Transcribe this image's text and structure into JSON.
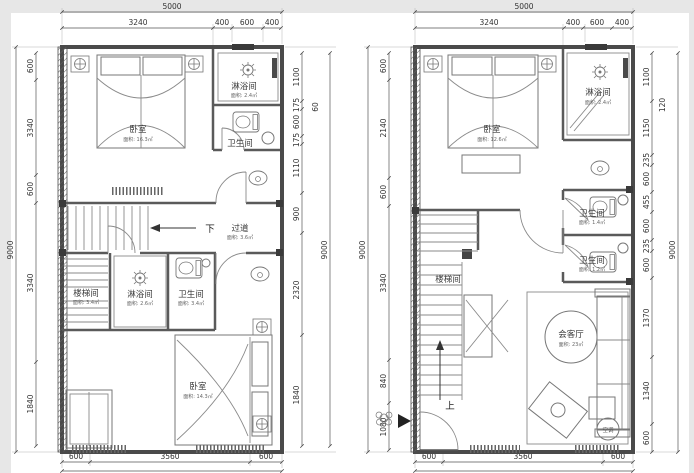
{
  "d": {
    "title": "duplex-floor-plans",
    "colors": {
      "wall": "#4a4a4a",
      "line": "#8a8a8a",
      "dim": "#555555",
      "text": "#333333",
      "paper": "#ffffff",
      "margin": "#e7e7e7"
    },
    "lp": {
      "overall_w": "5000",
      "top": [
        "3240",
        "400",
        "600",
        "400"
      ],
      "overall_h_l": "9000",
      "left": [
        "600",
        "3340",
        "600",
        "3340",
        "1840"
      ],
      "overall_h_r": "9000",
      "right": [
        "1100",
        "175",
        "600",
        "175",
        "1110",
        "900",
        "2320",
        "1840"
      ],
      "right_sec": "60",
      "bottom": [
        "600",
        "3560",
        "600"
      ],
      "rooms": {
        "bedroom_top": {
          "label": "卧室",
          "area": "面积: 16.3㎡"
        },
        "shower_top": {
          "label": "淋浴间",
          "area": "面积: 2.4㎡"
        },
        "wc_top": {
          "label": "卫生间",
          "area": "面积: 2.1㎡"
        },
        "corridor": {
          "label": "过道",
          "area": "面积: 3.6㎡",
          "dir": "下"
        },
        "stair": {
          "label": "楼梯间",
          "area": "面积: 3.4㎡"
        },
        "shower_mid": {
          "label": "淋浴间",
          "area": "面积: 2.6㎡"
        },
        "wc_mid": {
          "label": "卫生间",
          "area": "面积: 3.4㎡"
        },
        "bedroom_bottom": {
          "label": "卧室",
          "area": "面积: 14.3㎡"
        }
      }
    },
    "rp": {
      "overall_w": "5000",
      "top": [
        "3240",
        "400",
        "600",
        "400"
      ],
      "overall_h_l": "9000",
      "left": [
        "600",
        "2140",
        "600",
        "3340",
        "840",
        "1080"
      ],
      "overall_h_r": "9000",
      "right": [
        "1100",
        "1150",
        "235",
        "600",
        "455",
        "600",
        "235",
        "600",
        "1370",
        "1340",
        "600"
      ],
      "right_sec": "120",
      "bottom": [
        "600",
        "3560",
        "600"
      ],
      "rooms": {
        "bedroom": {
          "label": "卧室",
          "area": "面积: 12.6㎡"
        },
        "shower": {
          "label": "淋浴间",
          "area": "面积: 2.4㎡"
        },
        "wc1": {
          "label": "卫生间",
          "area": "面积: 1.4㎡"
        },
        "wc2": {
          "label": "卫生间",
          "area": "面积: 1.2㎡"
        },
        "stair": {
          "label": "楼梯间",
          "area": ""
        },
        "living": {
          "label": "会客厅",
          "area": "面积: 23㎡"
        },
        "ac": {
          "label": "空调"
        },
        "dir_up": "上"
      }
    }
  }
}
